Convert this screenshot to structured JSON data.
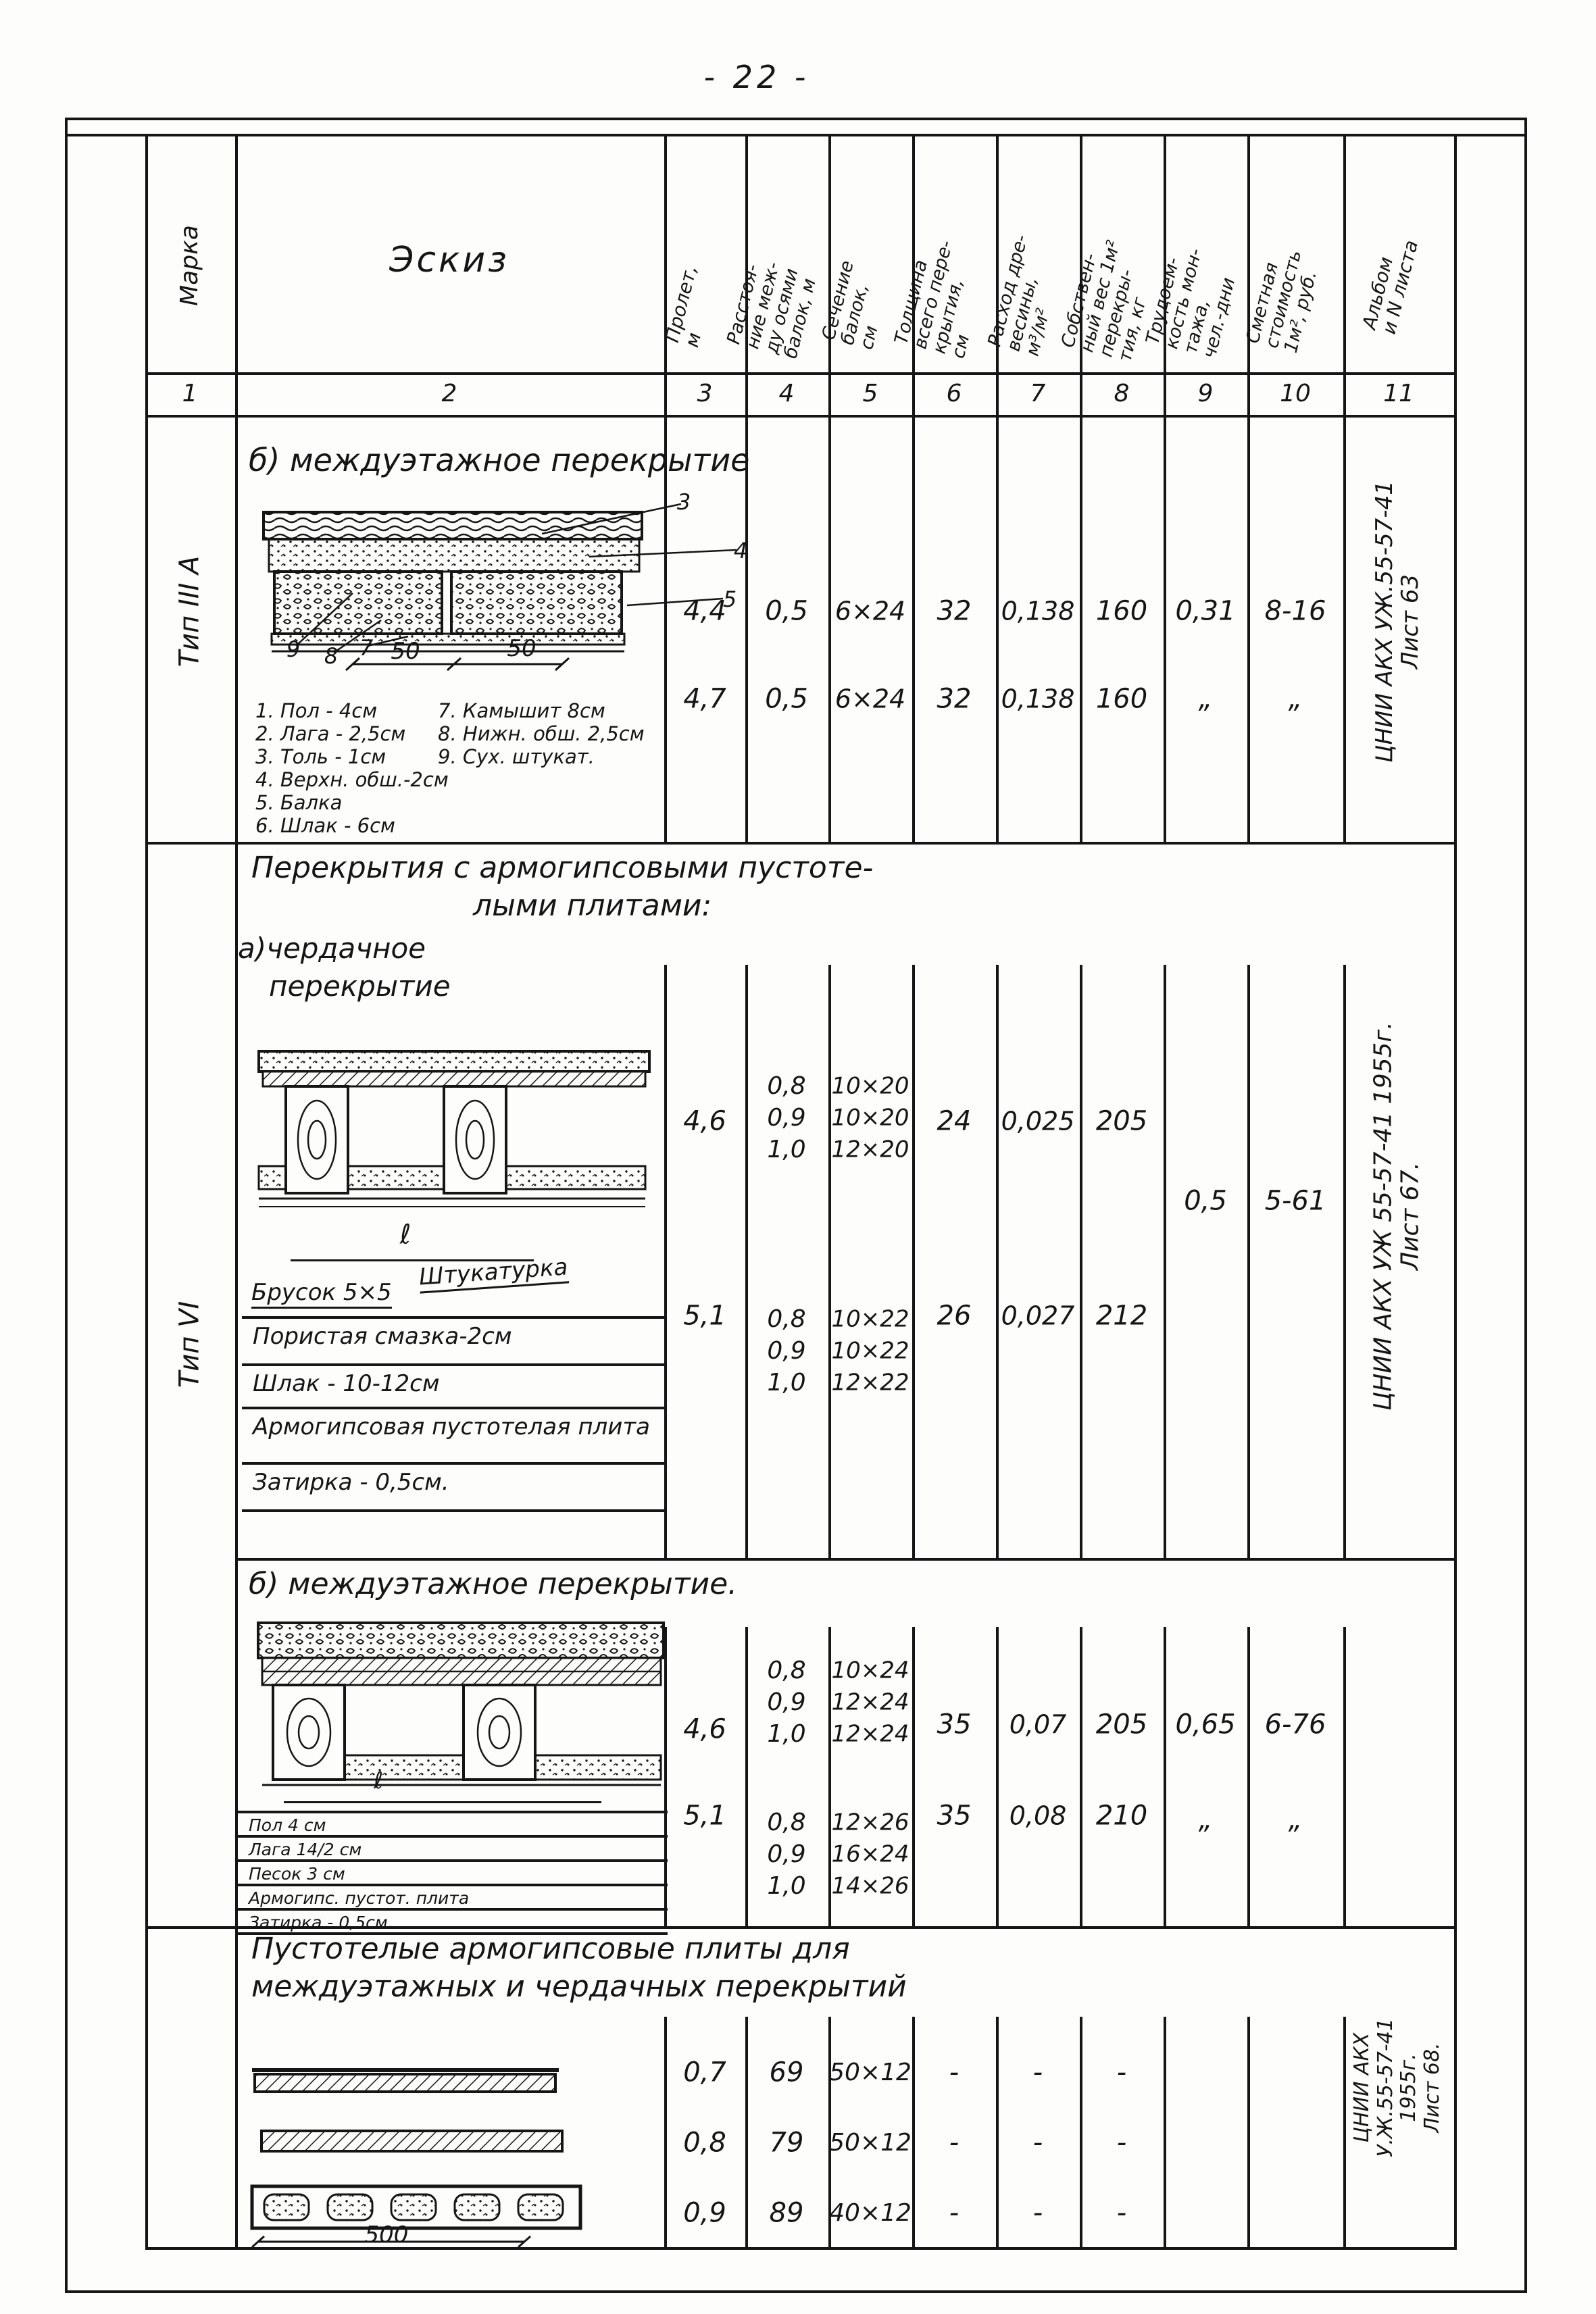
{
  "page_number": "- 22 -",
  "table": {
    "headers": {
      "col1": "Марка",
      "col2": "Эскиз",
      "col3": "Пролет,\nм",
      "col4": "Расстоя-\nние меж-\nду осями\nбалок, м",
      "col5": "Сечение\nбалок,\nсм",
      "col6": "Толщина\nвсего пере-\nкрытия,\nсм",
      "col7": "Расход дре-\nвесины,\nм³/м²",
      "col8": "Собствен-\nный вес 1м²\nперекры-\nтия, кг",
      "col9": "Трудоем-\nкость мон-\nтажа,\nчел.-дни",
      "col10": "Сметная\nстоимость\n1м², руб.",
      "col11": "Альбом\nи N листа"
    },
    "column_numbers": [
      "1",
      "2",
      "3",
      "4",
      "5",
      "6",
      "7",
      "8",
      "9",
      "10",
      "11"
    ]
  },
  "sections": [
    {
      "marka": "Тип III А",
      "title": "б) междуэтажное перекрытие",
      "sketch": {
        "callout_3": "3",
        "callout_4": "4",
        "callout_5": "5",
        "callout_9": "9",
        "callout_8": "8",
        "callout_7": "7",
        "dim_left": "50",
        "dim_right": "50"
      },
      "legend_left": [
        "1. Пол - 4см",
        "2. Лага - 2,5см",
        "3. Толь - 1см",
        "4. Верхн. обш.-2см",
        "5. Балка",
        "6. Шлак - 6см"
      ],
      "legend_right": [
        "7. Камышит 8см",
        "8. Нижн. обш. 2,5см",
        "9. Сух. штукат."
      ],
      "rows": [
        {
          "c3": "4,4",
          "c4": "0,5",
          "c5": "6×24",
          "c6": "32",
          "c7": "0,138",
          "c8": "160",
          "c9": "0,31",
          "c10": "8-16"
        },
        {
          "c3": "4,7",
          "c4": "0,5",
          "c5": "6×24",
          "c6": "32",
          "c7": "0,138",
          "c8": "160",
          "c9": "„",
          "c10": "„"
        }
      ],
      "album": "ЦНИИ АКХ УЖ.55-57-41\nЛист 63"
    },
    {
      "marka": "Тип VI",
      "title_line1": "Перекрытия с армогипсовыми пустоте-",
      "title_line2": "лыми    плитами:",
      "subtitle_line1": "а)чердачное",
      "subtitle_line2": "перекрытие",
      "sketch": {
        "dim": "ℓ",
        "label_brusok": "Брусок 5×5",
        "label_shtukaturka": "Штукатурка",
        "layers": [
          "Пористая смазка-2см",
          "Шлак - 10-12см",
          "Армогипсовая пустотелая плита",
          "Затирка - 0,5см."
        ]
      },
      "rows": [
        {
          "c3": "4,6",
          "c4": "0,8\n0,9\n1,0",
          "c5": "10×20\n10×20\n12×20",
          "c6": "24",
          "c7": "0,025",
          "c8": "205"
        },
        {
          "c3": "5,1",
          "c4": "0,8\n0,9\n1,0",
          "c5": "10×22\n10×22\n12×22",
          "c6": "26",
          "c7": "0,027",
          "c8": "212"
        }
      ],
      "section_values": {
        "c9": "0,5",
        "c10": "5-61"
      },
      "album": "ЦНИИ АКХ УЖ 55-57-41  1955г.\nЛист 67."
    },
    {
      "title": "б) междуэтажное перекрытие.",
      "sketch": {
        "dim": "ℓ",
        "layers": [
          "Пол 4 см",
          "Лага 14/2 см",
          "Песок 3 см",
          "Армогипс. пустот. плита",
          "Затирка - 0,5см."
        ]
      },
      "rows": [
        {
          "c3": "4,6",
          "c4": "0,8\n0,9\n1,0",
          "c5": "10×24\n12×24\n12×24",
          "c6": "35",
          "c7": "0,07",
          "c8": "205",
          "c9": "0,65",
          "c10": "6-76"
        },
        {
          "c3": "5,1",
          "c4": "0,8\n0,9\n1,0",
          "c5": "12×26\n16×24\n14×26",
          "c6": "35",
          "c7": "0,08",
          "c8": "210",
          "c9": "„",
          "c10": "„"
        }
      ]
    },
    {
      "title_line1": "Пустотелые армогипсовые плиты для",
      "title_line2": "междуэтажных и чердачных перекрытий",
      "sketch": {
        "dim": "500"
      },
      "rows": [
        {
          "c3": "0,7",
          "c4": "69",
          "c5": "50×12",
          "c6": "-",
          "c7": "-",
          "c8": "-"
        },
        {
          "c3": "0,8",
          "c4": "79",
          "c5": "50×12",
          "c6": "-",
          "c7": "-",
          "c8": "-"
        },
        {
          "c3": "0,9",
          "c4": "89",
          "c5": "40×12",
          "c6": "-",
          "c7": "-",
          "c8": "-"
        }
      ],
      "album": "ЦНИИ АКХ\nУ.Ж.55-57-41\n1955г.\nЛист 68."
    }
  ]
}
